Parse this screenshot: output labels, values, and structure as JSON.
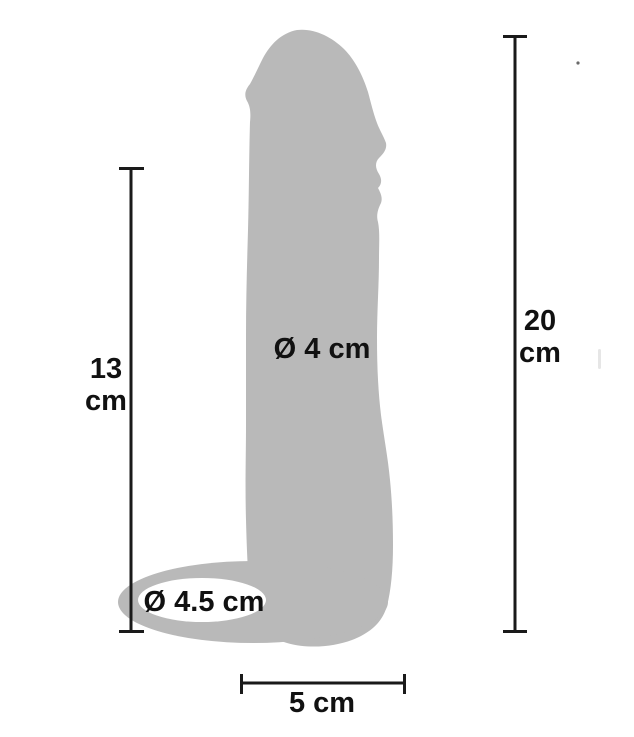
{
  "diagram": {
    "background_color": "#ffffff",
    "silhouette_color": "#b9b9b9",
    "line_color": "#1a1a1a",
    "text_color": "#111111",
    "measurements": {
      "inner_length": {
        "value": "13",
        "unit": "cm"
      },
      "total_length": {
        "value": "20",
        "unit": "cm"
      },
      "shaft_diameter": {
        "label": "Ø 4 cm"
      },
      "ring_diameter": {
        "label": "Ø 4.5 cm"
      },
      "base_width": {
        "label": "5 cm"
      }
    }
  }
}
